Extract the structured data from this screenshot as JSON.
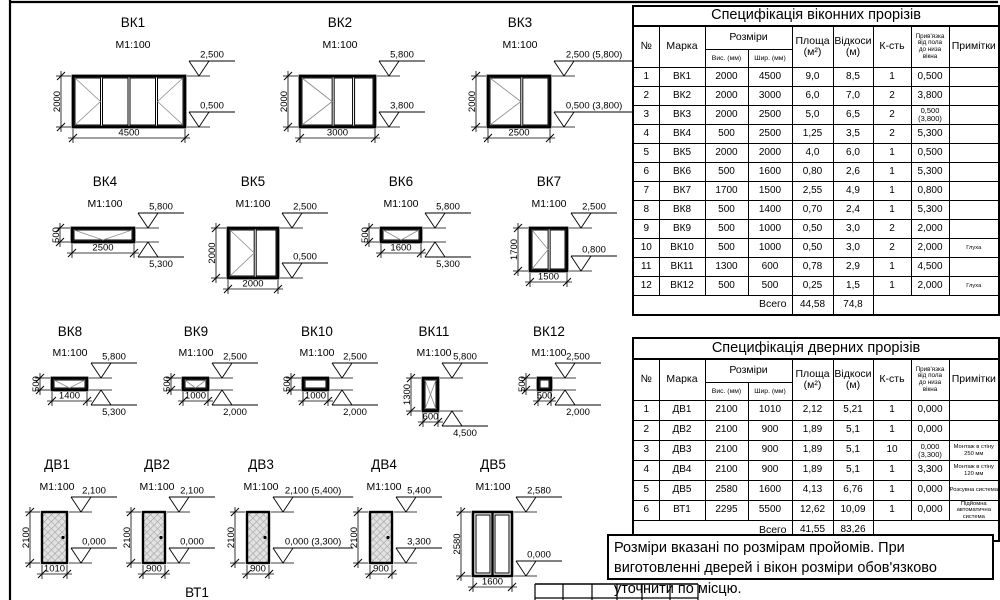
{
  "colors": {
    "line": "#000000",
    "mark": "#8a8a8a",
    "hatch_fill": "#e2e2e2",
    "hatch_line": "#8f8f8f"
  },
  "note": {
    "text": "Розміри вказані по розмірам пройомів. При виготовленні дверей і вікон розміри обов'язково уточнити по місцю."
  },
  "window_table": {
    "title": "Специфікація  віконних прорізів",
    "headers": {
      "num": "№",
      "mark": "Марка",
      "sizes": "Розміри",
      "height": "Вис. (мм)",
      "width": "Шир. (мм)",
      "area": "Площа|(м²)",
      "slopes": "Відкоси|(м)",
      "qty": "К-сть",
      "binding": "Прив'язка|від пола|до низа|вікна",
      "notes": "Примітки"
    },
    "rows": [
      [
        "1",
        "ВК1",
        "2000",
        "4500",
        "9,0",
        "8,5",
        "1",
        "0,500",
        ""
      ],
      [
        "2",
        "ВК2",
        "2000",
        "3000",
        "6,0",
        "7,0",
        "2",
        "3,800",
        ""
      ],
      [
        "3",
        "ВК3",
        "2000",
        "2500",
        "5,0",
        "6,5",
        "2",
        "0,500 (3,800)",
        ""
      ],
      [
        "4",
        "ВК4",
        "500",
        "2500",
        "1,25",
        "3,5",
        "2",
        "5,300",
        ""
      ],
      [
        "5",
        "ВК5",
        "2000",
        "2000",
        "4,0",
        "6,0",
        "1",
        "0,500",
        ""
      ],
      [
        "6",
        "ВК6",
        "500",
        "1600",
        "0,80",
        "2,6",
        "1",
        "5,300",
        ""
      ],
      [
        "7",
        "ВК7",
        "1700",
        "1500",
        "2,55",
        "4,9",
        "1",
        "0,800",
        ""
      ],
      [
        "8",
        "ВК8",
        "500",
        "1400",
        "0,70",
        "2,4",
        "1",
        "5,300",
        ""
      ],
      [
        "9",
        "ВК9",
        "500",
        "1000",
        "0,50",
        "3,0",
        "2",
        "2,000",
        ""
      ],
      [
        "10",
        "ВК10",
        "500",
        "1000",
        "0,50",
        "3,0",
        "2",
        "2,000",
        "Глуха"
      ],
      [
        "11",
        "ВК11",
        "1300",
        "600",
        "0,78",
        "2,9",
        "1",
        "4,500",
        ""
      ],
      [
        "12",
        "ВК12",
        "500",
        "500",
        "0,25",
        "1,5",
        "1",
        "2,000",
        "Глуха"
      ]
    ],
    "total": {
      "label": "Всего",
      "area": "44,58",
      "slopes": "74,8"
    }
  },
  "door_table": {
    "title": "Специфікація  дверних прорізів",
    "headers": {
      "num": "№",
      "mark": "Марка",
      "sizes": "Розміри",
      "height": "Вис. (мм)",
      "width": "Шир. (мм)",
      "area": "Площа|(м²)",
      "slopes": "Відкоси|(м)",
      "qty": "К-сть",
      "binding": "Прив'язка|від пола|до низа|вікна",
      "notes": "Примітки"
    },
    "rows": [
      [
        "1",
        "ДВ1",
        "2100",
        "1010",
        "2,12",
        "5,21",
        "1",
        "0,000",
        ""
      ],
      [
        "2",
        "ДВ2",
        "2100",
        "900",
        "1,89",
        "5,1",
        "1",
        "0,000",
        ""
      ],
      [
        "3",
        "ДВ3",
        "2100",
        "900",
        "1,89",
        "5,1",
        "10",
        "0,000 (3,300)",
        "Монтаж в стіну 250 мм"
      ],
      [
        "4",
        "ДВ4",
        "2100",
        "900",
        "1,89",
        "5,1",
        "1",
        "3,300",
        "Монтаж в стіну 120 мм"
      ],
      [
        "5",
        "ДВ5",
        "2580",
        "1600",
        "4,13",
        "6,76",
        "1",
        "0,000",
        "Розсувна система"
      ],
      [
        "6",
        "ВТ1",
        "2295",
        "5500",
        "12,62",
        "10,09",
        "1",
        "0,000",
        "Підйомна автоматична система"
      ]
    ],
    "total": {
      "label": "Всего",
      "area": "41,55",
      "slopes": "83,26"
    }
  },
  "figures": [
    {
      "id": "vk1",
      "label": "ВК1",
      "scale": "M1:100",
      "kind": "window",
      "rect": [
        73,
        76,
        112,
        51
      ],
      "panes": [
        {
          "f": 0.25,
          "m": ">"
        },
        {
          "f": 0.25
        },
        {
          "f": 0.25
        },
        {
          "f": 0.25,
          "m": "<"
        }
      ],
      "dims": {
        "w": "4500",
        "h": "2000"
      },
      "elevs": [
        {
          "t": "2,500",
          "at": "top",
          "style": "above"
        },
        {
          "t": "0,500",
          "at": "bottom",
          "style": "above"
        }
      ],
      "title_xy": [
        133,
        27
      ],
      "scale_y": 48
    },
    {
      "id": "vk2",
      "label": "ВК2",
      "scale": "M1:100",
      "kind": "window",
      "rect": [
        300,
        76,
        75,
        51
      ],
      "panes": [
        {
          "f": 0.45,
          "m": ">"
        },
        {
          "f": 0.275
        },
        {
          "f": 0.275
        }
      ],
      "dims": {
        "w": "3000",
        "h": "2000"
      },
      "elevs": [
        {
          "t": "5,800",
          "at": "top",
          "style": "above"
        },
        {
          "t": "3,800",
          "at": "bottom",
          "style": "above"
        }
      ],
      "title_xy": [
        340,
        27
      ],
      "scale_y": 48
    },
    {
      "id": "vk3",
      "label": "ВК3",
      "scale": "M1:100",
      "kind": "window",
      "rect": [
        488,
        76,
        62,
        51
      ],
      "panes": [
        {
          "f": 0.55,
          "m": ">"
        },
        {
          "f": 0.45
        }
      ],
      "dims": {
        "w": "2500",
        "h": "2000"
      },
      "elevs": [
        {
          "t": "2,500 (5,800)",
          "at": "top",
          "style": "above"
        },
        {
          "t": "0,500 (3,800)",
          "at": "bottom",
          "style": "above"
        }
      ],
      "title_xy": [
        520,
        27
      ],
      "scale_y": 48
    },
    {
      "id": "vk4",
      "label": "ВК4",
      "scale": "M1:100",
      "kind": "window",
      "rect": [
        72,
        228,
        62,
        14
      ],
      "panes": [
        {
          "f": 1,
          "m": "v"
        }
      ],
      "dims": {
        "w": "2500",
        "h": "500"
      },
      "elevs": [
        {
          "t": "5,800",
          "at": "top",
          "style": "above"
        },
        {
          "t": "5,300",
          "at": "bottom",
          "style": "below"
        }
      ],
      "title_xy": [
        105,
        186
      ],
      "scale_y": 207
    },
    {
      "id": "vk5",
      "label": "ВК5",
      "scale": "M1:100",
      "kind": "window",
      "rect": [
        228,
        228,
        50,
        50
      ],
      "panes": [
        {
          "f": 0.55,
          "m": ">"
        },
        {
          "f": 0.45
        }
      ],
      "dims": {
        "w": "2000",
        "h": "2000"
      },
      "elevs": [
        {
          "t": "2,500",
          "at": "top",
          "style": "above"
        },
        {
          "t": "0,500",
          "at": "bottom",
          "style": "above"
        }
      ],
      "title_xy": [
        253,
        186
      ],
      "scale_y": 207
    },
    {
      "id": "vk6",
      "label": "ВК6",
      "scale": "M1:100",
      "kind": "window",
      "rect": [
        381,
        228,
        40,
        14
      ],
      "panes": [
        {
          "f": 1,
          "m": "v"
        }
      ],
      "dims": {
        "w": "1600",
        "h": "500"
      },
      "elevs": [
        {
          "t": "5,800",
          "at": "top",
          "style": "above"
        },
        {
          "t": "5,300",
          "at": "bottom",
          "style": "below"
        }
      ],
      "title_xy": [
        401,
        186
      ],
      "scale_y": 207
    },
    {
      "id": "vk7",
      "label": "ВК7",
      "scale": "M1:100",
      "kind": "window",
      "rect": [
        530,
        228,
        37,
        43
      ],
      "panes": [
        {
          "f": 0.52,
          "m": ">"
        },
        {
          "f": 0.48
        }
      ],
      "dims": {
        "w": "1500",
        "h": "1700"
      },
      "elevs": [
        {
          "t": "2,500",
          "at": "top",
          "style": "above"
        },
        {
          "t": "0,800",
          "at": "bottom",
          "style": "above"
        }
      ],
      "title_xy": [
        549,
        186
      ],
      "scale_y": 207
    },
    {
      "id": "vk8",
      "label": "ВК8",
      "scale": "M1:100",
      "kind": "window",
      "rect": [
        52,
        378,
        35,
        12
      ],
      "panes": [
        {
          "f": 1,
          "m": "v"
        }
      ],
      "dims": {
        "w": "1400",
        "h": "500"
      },
      "elevs": [
        {
          "t": "5,800",
          "at": "top",
          "style": "above"
        },
        {
          "t": "5,300",
          "at": "bottom",
          "style": "below"
        }
      ],
      "title_xy": [
        70,
        336
      ],
      "scale_y": 356
    },
    {
      "id": "vk9",
      "label": "ВК9",
      "scale": "M1:100",
      "kind": "window",
      "rect": [
        183,
        378,
        25,
        12
      ],
      "panes": [
        {
          "f": 1,
          "m": "v"
        }
      ],
      "dims": {
        "w": "1000",
        "h": "500"
      },
      "elevs": [
        {
          "t": "2,500",
          "at": "top",
          "style": "above"
        },
        {
          "t": "2,000",
          "at": "bottom",
          "style": "below"
        }
      ],
      "title_xy": [
        196,
        336
      ],
      "scale_y": 356
    },
    {
      "id": "vk10",
      "label": "ВК10",
      "scale": "M1:100",
      "kind": "window",
      "rect": [
        303,
        378,
        25,
        12
      ],
      "panes": [
        {
          "f": 1
        }
      ],
      "dims": {
        "w": "1000",
        "h": "500"
      },
      "elevs": [
        {
          "t": "2,500",
          "at": "top",
          "style": "above"
        },
        {
          "t": "2,000",
          "at": "bottom",
          "style": "below"
        }
      ],
      "title_xy": [
        317,
        336
      ],
      "scale_y": 356
    },
    {
      "id": "vk11",
      "label": "ВК11",
      "scale": "M1:100",
      "kind": "window",
      "rect": [
        423,
        378,
        15,
        33
      ],
      "panes": [
        {
          "f": 1,
          "m": "x"
        }
      ],
      "dims": {
        "w": "600",
        "h": "1300"
      },
      "elevs": [
        {
          "t": "5,800",
          "at": "top",
          "style": "above"
        },
        {
          "t": "4,500",
          "at": "bottom",
          "style": "below"
        }
      ],
      "title_xy": [
        434,
        336
      ],
      "scale_y": 356
    },
    {
      "id": "vk12",
      "label": "ВК12",
      "scale": "M1:100",
      "kind": "window",
      "rect": [
        538,
        378,
        13,
        12
      ],
      "panes": [
        {
          "f": 1
        }
      ],
      "dims": {
        "w": "500",
        "h": "500"
      },
      "elevs": [
        {
          "t": "2,500",
          "at": "top",
          "style": "above"
        },
        {
          "t": "2,000",
          "at": "bottom",
          "style": "below"
        }
      ],
      "title_xy": [
        549,
        336
      ],
      "scale_y": 356
    },
    {
      "id": "dv1",
      "label": "ДВ1",
      "scale": "M1:100",
      "kind": "door",
      "rect": [
        42,
        512,
        25,
        51
      ],
      "dims": {
        "w": "1010",
        "h": "2100"
      },
      "elevs": [
        {
          "t": "2,100",
          "at": "top",
          "style": "above"
        },
        {
          "t": "0,000",
          "at": "bottom",
          "style": "above"
        }
      ],
      "title_xy": [
        57,
        469
      ],
      "scale_y": 490
    },
    {
      "id": "dv2",
      "label": "ДВ2",
      "scale": "M1:100",
      "kind": "door",
      "rect": [
        143,
        512,
        22,
        51
      ],
      "dims": {
        "w": "900",
        "h": "2100"
      },
      "elevs": [
        {
          "t": "2,100",
          "at": "top",
          "style": "above"
        },
        {
          "t": "0,000",
          "at": "bottom",
          "style": "above"
        }
      ],
      "title_xy": [
        157,
        469
      ],
      "scale_y": 490
    },
    {
      "id": "dv3",
      "label": "ДВ3",
      "scale": "M1:100",
      "kind": "door",
      "rect": [
        247,
        512,
        22,
        51
      ],
      "dims": {
        "w": "900",
        "h": "2100"
      },
      "elevs": [
        {
          "t": "2,100 (5,400)",
          "at": "top",
          "style": "above"
        },
        {
          "t": "0,000 (3,300)",
          "at": "bottom",
          "style": "above"
        }
      ],
      "title_xy": [
        261,
        469
      ],
      "scale_y": 490
    },
    {
      "id": "dv4",
      "label": "ДВ4",
      "scale": "M1:100",
      "kind": "door",
      "rect": [
        370,
        512,
        22,
        51
      ],
      "dims": {
        "w": "900",
        "h": "2100"
      },
      "elevs": [
        {
          "t": "5,400",
          "at": "top",
          "style": "above"
        },
        {
          "t": "3,300",
          "at": "bottom",
          "style": "above"
        }
      ],
      "title_xy": [
        384,
        469
      ],
      "scale_y": 490
    },
    {
      "id": "dv5",
      "label": "ДВ5",
      "scale": "M1:100",
      "kind": "door2",
      "rect": [
        473,
        512,
        39,
        64
      ],
      "dims": {
        "w": "1600",
        "h": "2580"
      },
      "elevs": [
        {
          "t": "2,580",
          "at": "top",
          "style": "above"
        },
        {
          "t": "0,000",
          "at": "bottom",
          "style": "above"
        }
      ],
      "title_xy": [
        493,
        469
      ],
      "scale_y": 490
    },
    {
      "id": "vt1",
      "label": "ВТ1",
      "kind": "label",
      "title_xy": [
        197,
        597
      ]
    }
  ],
  "frame": {
    "left_x": 10,
    "top_y": 2
  },
  "title_block": {
    "x1": 535,
    "x2": 698,
    "y_top": 584,
    "y_mid": 598,
    "verticals": [
      535,
      563,
      592,
      617,
      642,
      670,
      698
    ]
  }
}
